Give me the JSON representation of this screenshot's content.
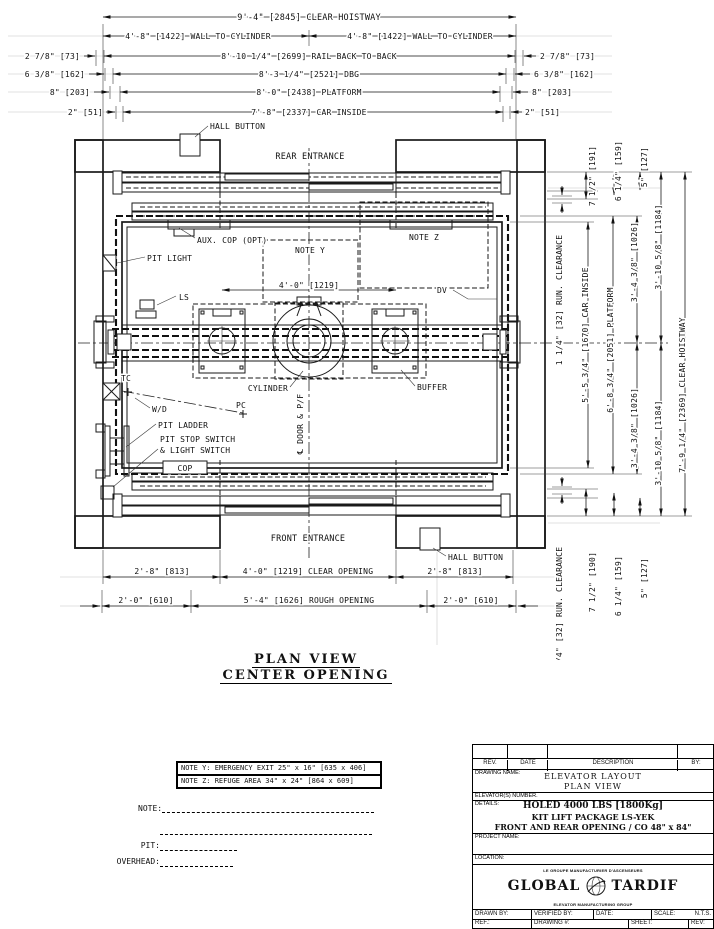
{
  "dims_top": {
    "clear_hoistway": "9'-4\" [2845] CLEAR HOISTWAY",
    "wall_to_cyl_left": "4'-8\" [1422] WALL TO CYLINDER",
    "wall_to_cyl_right": "4'-8\" [1422] WALL TO CYLINDER",
    "rail_back": "8'-10 1/4\" [2699] RAIL BACK TO BACK",
    "dbg": "8'-3 1/4\" [2521] DBG",
    "platform": "8'-0\" [2438] PLATFORM",
    "car_inside": "7'-8\" [2337] CAR INSIDE",
    "l1": "2 7/8\" [73]",
    "l2": "6 3/8\" [162]",
    "l3": "8\" [203]",
    "l4": "2\" [51]",
    "r1": "2 7/8\" [73]",
    "r2": "6 3/8\" [162]",
    "r3": "8\" [203]",
    "r4": "2\" [51]"
  },
  "plan": {
    "rear_entrance": "REAR ENTRANCE",
    "front_entrance": "FRONT ENTRANCE",
    "hall_button_top": "HALL BUTTON",
    "hall_button_bottom": "HALL BUTTON",
    "aux_cop": "AUX. COP (OPT)",
    "note_y": "NOTE Y",
    "note_z": "NOTE Z",
    "pit_light": "PIT LIGHT",
    "ls": "LS",
    "dim_door": "4'-0\" [1219]",
    "dv": "DV",
    "cylinder": "CYLINDER",
    "buffer": "BUFFER",
    "tc": "TC",
    "wd": "W/D",
    "pc": "PC",
    "pit_ladder": "PIT LADDER",
    "pit_stop_1": "PIT STOP SWITCH",
    "pit_stop_2": "& LIGHT SWITCH",
    "cop": "COP",
    "door_cl": "℄ DOOR & P/F"
  },
  "dims_bottom": {
    "b1l": "2'-8\" [813]",
    "b1c": "4'-0\" [1219] CLEAR OPENING",
    "b1r": "2'-8\" [813]",
    "b2l": "2'-0\" [610]",
    "b2c": "5'-4\" [1626] ROUGH OPENING",
    "b2r": "2'-0\" [610]"
  },
  "dims_right": {
    "run_top": "1 1/4\" [32] RUN. CLEARANCE",
    "d7t": "7 1/2\" [191]",
    "d6t": "6 1/4\" [159]",
    "d5t": "5\" [127]",
    "car_inside": "5'-5 3/4\" [1670] CAR INSIDE",
    "platform": "6'-8 3/4\" [2051] PLATFORM",
    "half_plat_t": "3'-4 3/8\" [1026]",
    "half_plat_b": "3'-4 3/8\" [1026]",
    "half_hoist_t": "3'-10 5/8\" [1184]",
    "half_hoist_b": "3'-10 5/8\" [1184]",
    "clear_hoistway": "7'-9 1/4\" [2369] CLEAR HOISTWAY",
    "run_bottom": "1 1/4\" [32] RUN. CLEARANCE",
    "d7b": "7 1/2\" [190]",
    "d6b": "6 1/4\" [159]",
    "d5b": "5\" [127]"
  },
  "title": {
    "line1": "PLAN VIEW",
    "line2": "CENTER OPENING"
  },
  "notes_box": {
    "note_y": "NOTE Y: EMERGENCY EXIT 25\" x 16\" [635 x 406]",
    "note_z": "NOTE Z: REFUGE AREA 34\" x 24\" [864 x 609]"
  },
  "footer_fields": {
    "note": "NOTE:",
    "pit": "PIT:",
    "overhead": "OVERHEAD:"
  },
  "title_block": {
    "rev": "REV.",
    "date": "DATE",
    "description": "DESCRIPTION",
    "by": "BY:",
    "drawing_name_label": "DRAWING NAME:",
    "drawing_name_1": "ELEVATOR LAYOUT",
    "drawing_name_2": "PLAN VIEW",
    "elevators_number": "ELEVATOR(S) NUMBER.",
    "details_label": "DETAILS:",
    "details_1": "HOLED 4000 LBS [1800Kg]",
    "details_2": "KIT LIFT PACKAGE LS-YEK",
    "details_3": "FRONT AND REAR OPENING / CO 48\" x 84\"",
    "project_name": "PROJECT NAME:",
    "location": "LOCATION:",
    "logo_top": "LE GROUPE MANUFACTURIER D'ASCENSEURS",
    "logo_left": "GLOBAL",
    "logo_right": "TARDIF",
    "logo_bottom": "ELEVATOR MANUFACTURING GROUP",
    "drawn_by": "DRAWN BY:",
    "verified_by": "VERIFIED BY:",
    "date2": "DATE:",
    "scale_label": "SCALE:",
    "scale_value": "N.T.S.",
    "ref": "REF.:",
    "drawing_no": "DRAWING #:",
    "sheet": "SHEET:",
    "rev2": "REV:"
  }
}
